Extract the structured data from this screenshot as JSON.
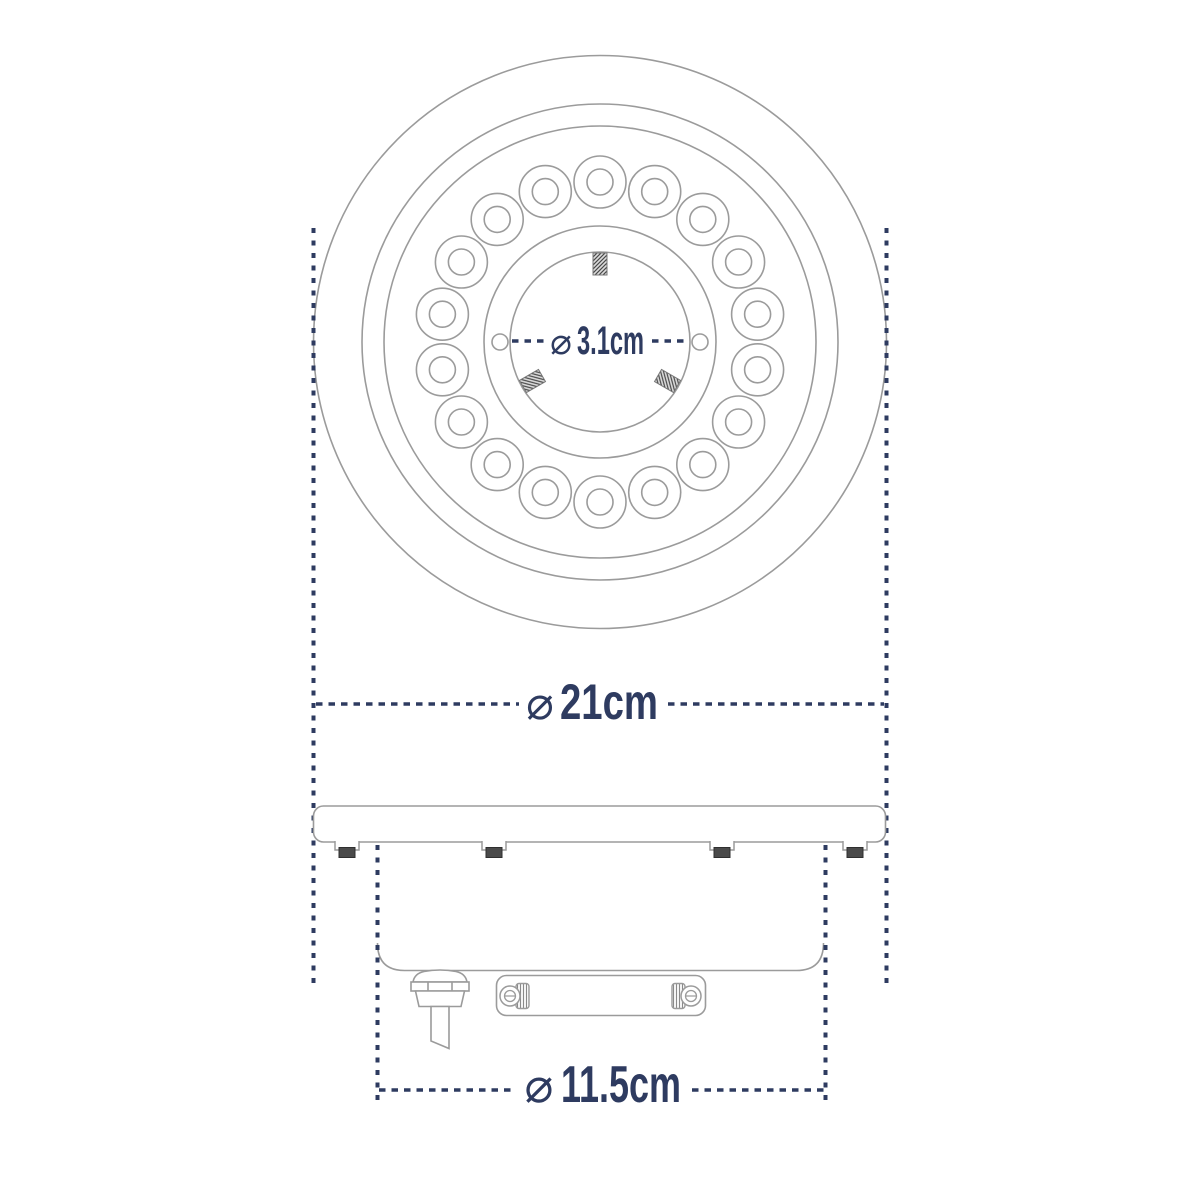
{
  "dimensions": {
    "hub": {
      "symbol": "⌀",
      "value": "3.1cm"
    },
    "overall": {
      "symbol": "⌀",
      "value": "21cm"
    },
    "body": {
      "symbol": "⌀",
      "value": "11.5cm"
    }
  },
  "counts": {
    "led_holes": 18,
    "center_studs": 3,
    "hub_side_holes": 2,
    "flange_screws": 4,
    "bracket_screws": 2
  },
  "colors": {
    "background": "#ffffff",
    "line_gray": "#9b9b9b",
    "dimension_navy": "#2e3b60",
    "screw_dark": "#4a4a4a"
  }
}
